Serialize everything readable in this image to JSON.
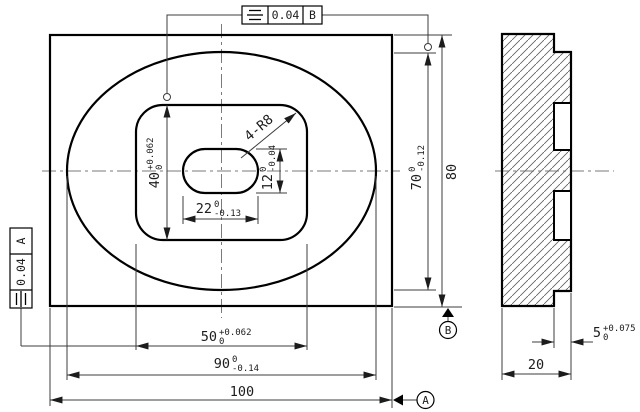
{
  "drawing": {
    "fcf_top": {
      "symbol": "symmetry",
      "tolerance": "0.04",
      "datum": "B"
    },
    "fcf_left": {
      "symbol": "symmetry",
      "tolerance": "0.04",
      "datum": "A"
    },
    "datum_a": "A",
    "datum_b": "B",
    "dims": {
      "d100": {
        "main": "100"
      },
      "d90": {
        "main": "90",
        "upper": "0",
        "lower": "-0.14"
      },
      "d50": {
        "main": "50",
        "upper": "+0.062",
        "lower": "0"
      },
      "d80": {
        "main": "80"
      },
      "d70": {
        "main": "70",
        "upper": "0",
        "lower": "-0.12"
      },
      "d40": {
        "main": "40",
        "upper": "+0.062",
        "lower": "0"
      },
      "d22": {
        "main": "22",
        "upper": "0",
        "lower": "-0.13"
      },
      "d12": {
        "main": "12",
        "upper": "0",
        "lower": "-0.04"
      },
      "r8": {
        "main": "4-R8"
      },
      "d20": {
        "main": "20"
      },
      "d5": {
        "main": "5",
        "upper": "+0.075",
        "lower": "0"
      }
    },
    "colors": {
      "line": "#000000",
      "thin": "#3c3c3c",
      "center": "#7a7a7a",
      "bg": "#ffffff"
    }
  }
}
